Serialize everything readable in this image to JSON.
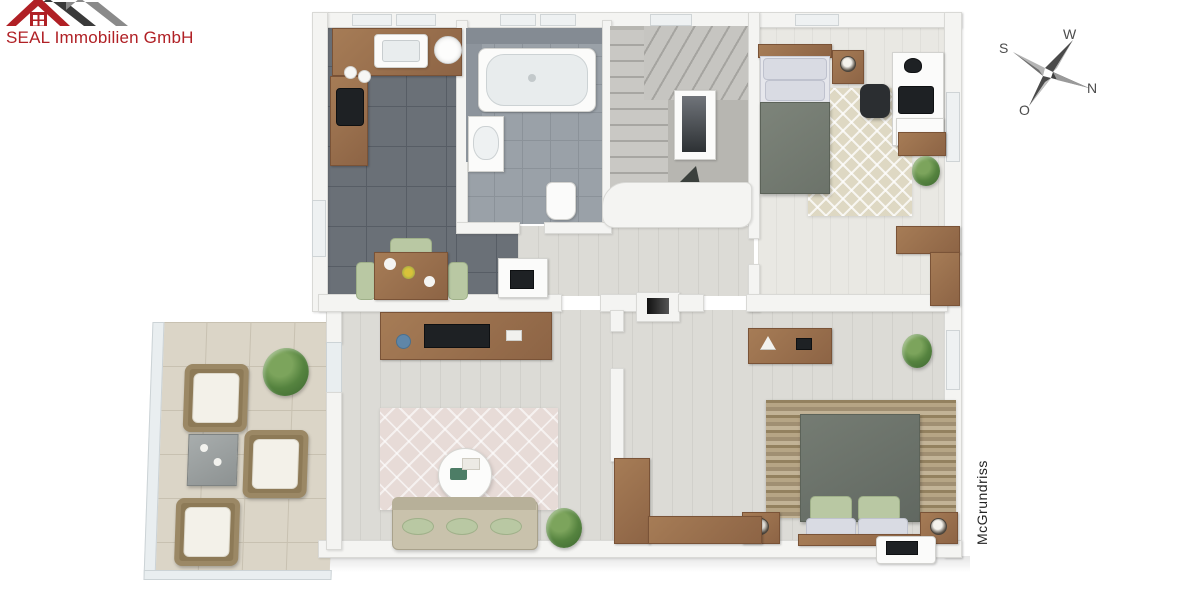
{
  "branding": {
    "company": "SEAL Immobilien GmbH",
    "accent_color": "#b02025",
    "logo_icon": "three-overlapping-house-roofs"
  },
  "compass": {
    "letters": {
      "w": "W",
      "s": "S",
      "o": "O",
      "n": "N"
    },
    "note": "german-compass-north-points-lower-right"
  },
  "watermark": {
    "text": "McGrundriss"
  },
  "floorplan": {
    "view": "3d-top-down-render",
    "rooms": [
      {
        "id": "kitchen",
        "floor": "dark-gray-tiles",
        "furniture": [
          "kitchen-counter",
          "sink",
          "round-basin",
          "tall-cabinet",
          "black-appliance",
          "dining-table",
          "green-chairs",
          "fireplace-stove"
        ]
      },
      {
        "id": "bathroom",
        "floor": "gray-tiles",
        "furniture": [
          "bathtub",
          "washbasin-vanity",
          "toilet"
        ]
      },
      {
        "id": "staircase",
        "floor": "gray-carpet",
        "furniture": [
          "winder-stairs",
          "stair-core",
          "banister",
          "down-arrow"
        ]
      },
      {
        "id": "bedroom-top",
        "floor": "light-planks",
        "furniture": [
          "single-bed",
          "nightstand",
          "table-lamp",
          "patterned-rug",
          "desk",
          "monitor",
          "office-chair",
          "shelf",
          "plant",
          "corner-wardrobe"
        ]
      },
      {
        "id": "hallway",
        "floor": "light-planks",
        "furniture": []
      },
      {
        "id": "living-room",
        "floor": "light-planks",
        "furniture": [
          "sideboard",
          "tv",
          "coffee-table",
          "sofa",
          "green-cushions",
          "diamond-rug",
          "plant"
        ]
      },
      {
        "id": "bedroom-bottom",
        "floor": "light-planks",
        "furniture": [
          "double-bed",
          "green-pillows",
          "nightstand-left",
          "nightstand-right",
          "stone-rug",
          "console-dresser",
          "corner-wardrobe",
          "plant",
          "white-tray"
        ]
      },
      {
        "id": "terrace",
        "floor": "beige-stone-tiles",
        "furniture": [
          "wicker-armchair-1",
          "wicker-armchair-2",
          "wicker-armchair-3",
          "cube-side-table",
          "plant",
          "glass-railing"
        ]
      }
    ]
  },
  "colors": {
    "logo_red": "#b02025",
    "kitchen_tile": "#6a7077",
    "bath_tile": "#9aa1a8",
    "wood_furniture": "#9a7254",
    "sofa_beige": "#c9c2ac",
    "cushion_green": "#b9c8a3",
    "duvet_gray": "#747b72",
    "terrace_tile": "#dbd5c7",
    "wall_white": "#f4f4f2"
  }
}
